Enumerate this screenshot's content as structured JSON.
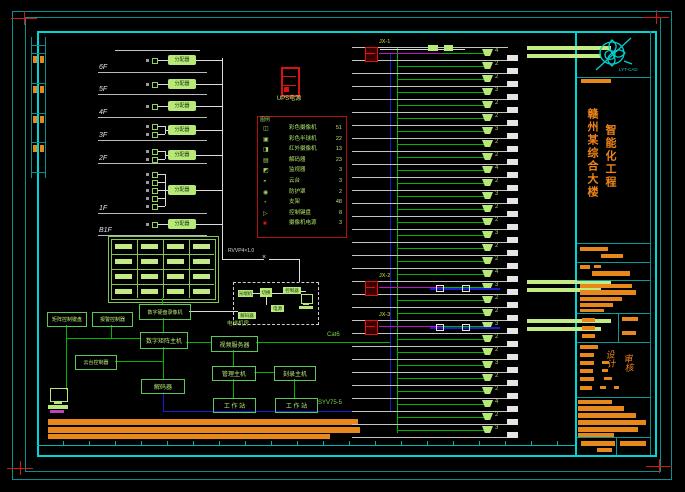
{
  "drawing": {
    "colors": {
      "frame_cyan": "#00d6d6",
      "dim_cyan": "#0a8f8f",
      "wire_green": "#00b400",
      "device_green": "#b8e878",
      "bar_green": "#c2ea85",
      "orange": "#e8871a",
      "red": "#dd1111",
      "magenta": "#c014c0",
      "blue": "#1a1ad0",
      "grey_line": "#c4c4c4",
      "white_line": "#dcdcdc"
    },
    "ups_label": "UPS电源",
    "rvvp_label": "RVVP4×1.0",
    "cat6_label": "Cat6",
    "syv_label": "SYV75-5",
    "elevator_caption": "电梯机房",
    "pill_label": "分配器",
    "left_riser": {
      "floors": [
        {
          "label": "6F",
          "line_y": 72,
          "wire_y": 60,
          "devices": 1
        },
        {
          "label": "5F",
          "line_y": 94,
          "wire_y": 84,
          "devices": 1
        },
        {
          "label": "4F",
          "line_y": 117,
          "wire_y": 106,
          "devices": 1
        },
        {
          "label": "3F",
          "line_y": 140,
          "wire_y": 130,
          "devices": 2
        },
        {
          "label": "2F",
          "line_y": 163,
          "wire_y": 155,
          "devices": 2
        },
        {
          "label": "1F",
          "line_y": 213,
          "wire_y": 190,
          "devices": 5
        },
        {
          "label": "B1F",
          "line_y": 235,
          "wire_y": 224,
          "devices": 1
        }
      ]
    },
    "monitor_wall": {
      "cols": 4,
      "rows": 4
    },
    "network_boxes": [
      {
        "id": "dvr-box",
        "label": "数字硬盘录像机",
        "x": 139,
        "y": 304,
        "w": 50,
        "h": 14,
        "f": 5
      },
      {
        "id": "matrix-box",
        "label": "数字矩阵主机",
        "x": 140,
        "y": 332,
        "w": 46,
        "h": 15,
        "f": 6
      },
      {
        "id": "keyboard-box",
        "label": "矩阵控制键盘",
        "x": 47,
        "y": 312,
        "w": 38,
        "h": 13,
        "f": 5
      },
      {
        "id": "alarm-box",
        "label": "报警控制器",
        "x": 92,
        "y": 312,
        "w": 39,
        "h": 13,
        "f": 5
      },
      {
        "id": "ptz-box",
        "label": "云台控制器",
        "x": 75,
        "y": 355,
        "w": 40,
        "h": 13,
        "f": 5
      },
      {
        "id": "decoder-box",
        "label": "解码器",
        "x": 141,
        "y": 379,
        "w": 42,
        "h": 13,
        "f": 6
      },
      {
        "id": "video-server-box",
        "label": "视频服务器",
        "x": 211,
        "y": 336,
        "w": 45,
        "h": 14,
        "f": 6
      },
      {
        "id": "mgmt-box",
        "label": "管理主机",
        "x": 212,
        "y": 366,
        "w": 42,
        "h": 13,
        "f": 6
      },
      {
        "id": "recorder-box",
        "label": "刻录主机",
        "x": 274,
        "y": 366,
        "w": 40,
        "h": 13,
        "f": 6
      },
      {
        "id": "workstation-1",
        "label": "工 作 站",
        "x": 213,
        "y": 398,
        "w": 41,
        "h": 13,
        "f": 6
      },
      {
        "id": "workstation-2",
        "label": "工 作 站",
        "x": 275,
        "y": 398,
        "w": 41,
        "h": 13,
        "f": 6
      }
    ],
    "elevator_pills": [
      {
        "id": "optical-box",
        "label": "光端机",
        "x": 238,
        "y": 290,
        "w": 15,
        "h": 7
      },
      {
        "id": "switch-box",
        "label": "切换",
        "x": 260,
        "y": 288,
        "w": 12,
        "h": 9
      },
      {
        "id": "controller-box",
        "label": "控制器",
        "x": 283,
        "y": 287,
        "w": 18,
        "h": 7
      },
      {
        "id": "power-box",
        "label": "电源",
        "x": 271,
        "y": 305,
        "w": 13,
        "h": 7
      },
      {
        "id": "sub-decoder-box",
        "label": "解码器",
        "x": 238,
        "y": 312,
        "w": 18,
        "h": 7
      }
    ],
    "legend": {
      "header": "图例",
      "rows": [
        {
          "icon": "◫",
          "name": "彩色摄像机",
          "qty": "51"
        },
        {
          "icon": "▣",
          "name": "彩色半球机",
          "qty": "22"
        },
        {
          "icon": "◨",
          "name": "红外摄像机",
          "qty": "13"
        },
        {
          "icon": "▤",
          "name": "解码器",
          "qty": "23"
        },
        {
          "icon": "◩",
          "name": "监视器",
          "qty": "3"
        },
        {
          "icon": "◓",
          "name": "云台",
          "qty": "3"
        },
        {
          "icon": "◉",
          "name": "防护罩",
          "qty": "2"
        },
        {
          "icon": "◔",
          "name": "支架",
          "qty": "48"
        },
        {
          "icon": "▷",
          "name": "控制键盘",
          "qty": "8"
        },
        {
          "icon": "■",
          "name": "摄像机电源",
          "qty": "3"
        }
      ]
    },
    "camera_riser": {
      "floor_lines": 31,
      "counts": [
        "4",
        "2",
        "2",
        "3",
        "2",
        "2",
        "3",
        "2",
        "2",
        "4",
        "2",
        "3",
        "2",
        "2",
        "3",
        "2",
        "2",
        "4",
        "3",
        "2",
        "2",
        "3",
        "2",
        "2",
        "3",
        "2",
        "2",
        "4",
        "2",
        "3"
      ],
      "specials": [
        {
          "k": 0,
          "label": "JX-1"
        },
        {
          "k": 18,
          "label": "JX-2"
        },
        {
          "k": 21,
          "label": "JX-3"
        }
      ]
    },
    "notes_bars": [
      [
        48,
        419,
        310,
        6
      ],
      [
        48,
        427,
        312,
        6
      ],
      [
        48,
        434,
        282,
        5
      ]
    ],
    "ladder": {
      "rungs": [
        45,
        53,
        83,
        113,
        142,
        172
      ],
      "pairs": [
        56,
        86,
        116,
        145
      ]
    }
  },
  "title_block": {
    "logo_text": "LYT-CAD",
    "project_col1": "赣州某综合大楼",
    "project_col2": "智能化工程",
    "sign_left": "设计",
    "sign_right": "审核",
    "dividers": [
      77,
      243,
      262,
      280,
      313,
      342,
      397,
      437
    ],
    "bars": [
      [
        581,
        79,
        30,
        4
      ],
      [
        580,
        247,
        28,
        4
      ],
      [
        601,
        254,
        22,
        4
      ],
      [
        580,
        265,
        10,
        4
      ],
      [
        594,
        265,
        7,
        3
      ],
      [
        592,
        271,
        38,
        5
      ],
      [
        580,
        284,
        52,
        4
      ],
      [
        580,
        290,
        56,
        5
      ],
      [
        580,
        297,
        42,
        4
      ],
      [
        580,
        303,
        33,
        4
      ],
      [
        580,
        309,
        24,
        3
      ],
      [
        582,
        318,
        13,
        4
      ],
      [
        582,
        326,
        13,
        4
      ],
      [
        582,
        334,
        13,
        4
      ],
      [
        622,
        317,
        16,
        4
      ],
      [
        622,
        331,
        14,
        4
      ],
      [
        580,
        345,
        18,
        4
      ],
      [
        580,
        353,
        14,
        4
      ],
      [
        580,
        361,
        14,
        4
      ],
      [
        580,
        369,
        13,
        4
      ],
      [
        580,
        377,
        14,
        4
      ],
      [
        580,
        386,
        12,
        4
      ],
      [
        602,
        361,
        7,
        3
      ],
      [
        602,
        369,
        6,
        3
      ],
      [
        604,
        377,
        8,
        3
      ],
      [
        600,
        386,
        6,
        3
      ],
      [
        614,
        386,
        5,
        3
      ],
      [
        578,
        400,
        34,
        4
      ],
      [
        578,
        406,
        46,
        5
      ],
      [
        578,
        413,
        58,
        5
      ],
      [
        578,
        420,
        68,
        5
      ],
      [
        578,
        427,
        60,
        5
      ],
      [
        578,
        433,
        36,
        4
      ],
      [
        581,
        441,
        34,
        5
      ],
      [
        597,
        448,
        15,
        4
      ],
      [
        620,
        441,
        26,
        5
      ]
    ]
  }
}
